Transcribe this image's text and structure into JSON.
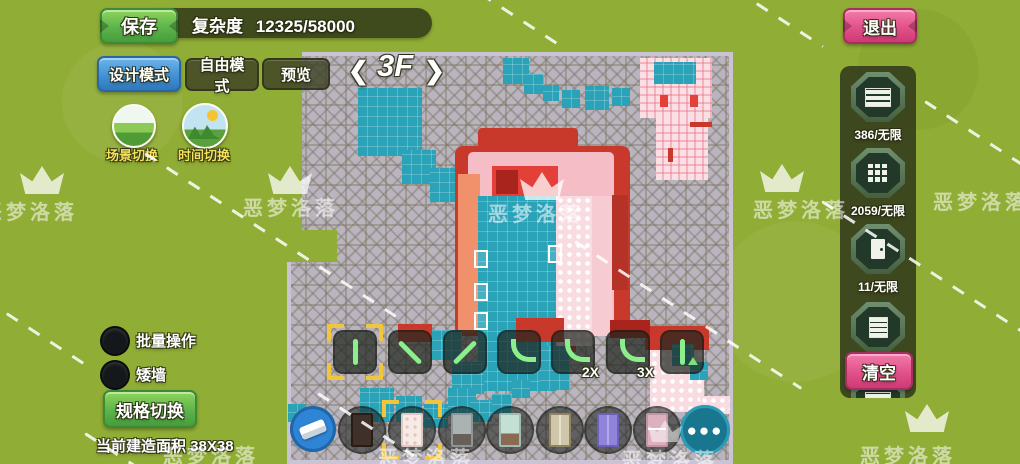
{
  "watermark": {
    "text": "恶梦洛落"
  },
  "header": {
    "save": "保存",
    "complexity_label": "复杂度",
    "complexity_value": "12325/58000",
    "exit": "退出"
  },
  "modes": {
    "design": "设计模式",
    "free": "自由模式",
    "preview": "预览"
  },
  "scene_toggles": {
    "scene": "场景切换",
    "time": "时间切换"
  },
  "floor": {
    "prev": "❮",
    "label": "3F",
    "next": "❯"
  },
  "left_panel": {
    "batch": "批量操作",
    "low_wall": "矮墙",
    "spec_switch": "规格切换",
    "area": "当前建造面积 38X38"
  },
  "materials": {
    "items": [
      {
        "icon": "brick-wall-icon",
        "count": "386/无限",
        "selected": true
      },
      {
        "icon": "floor-tile-icon",
        "count": "2059/无限",
        "selected": false
      },
      {
        "icon": "door-icon",
        "count": "11/无限",
        "selected": false
      },
      {
        "icon": "furniture-icon",
        "count": "91/无限",
        "selected": false
      }
    ],
    "clear": "清空"
  },
  "wall_tools": {
    "multiplier_2x": "2X",
    "multiplier_3x": "3X"
  },
  "hotbar": {
    "more": "●●●"
  },
  "colors": {
    "grass": "#90ad35",
    "floor_gray": "#b9b4bd",
    "teal_tile": "#2aa3b9",
    "wall_red": "#c8392b",
    "room_pink": "#f5bdc5",
    "save_green": "#5cb44a",
    "mode_blue": "#3f8fd2",
    "exit_pink": "#e2518b",
    "tool_glyph_green": "#8bf08b",
    "selection_yellow": "#f2c63c"
  }
}
